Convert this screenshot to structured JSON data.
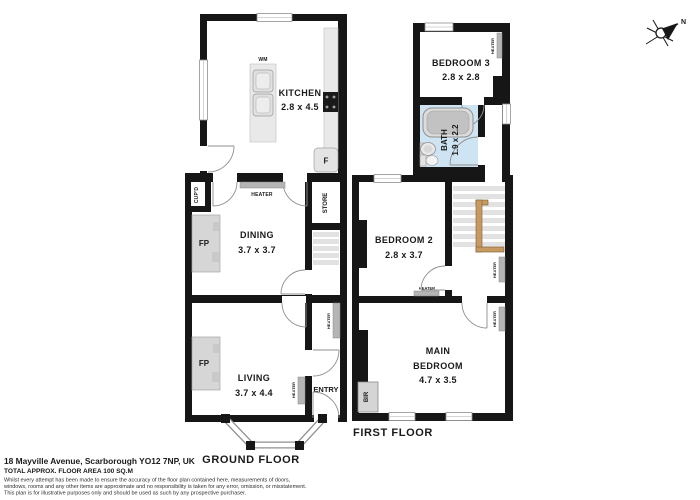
{
  "meta": {
    "address": "18 Mayville Avenue, Scarborough YO12 7NP, UK",
    "area": "TOTAL APPROX. FLOOR AREA 100 SQ.M",
    "disclaimer1": "Whilst every attempt has been made to ensure the accuracy of the floor plan contained here, measurements of doors,",
    "disclaimer2": "windows, rooms and any other items are approximate and no responsibility is taken for any error, omission, or misstatement.",
    "disclaimer3": "This plan is for illustrative purposes only and should be used as such by any prospective purchaser."
  },
  "compass": {
    "north": "N"
  },
  "labels": {
    "heater": "HEATER",
    "fireplace": "FP",
    "washing_machine": "WM",
    "fridge": "F",
    "store": "STORE",
    "cupboard": "CUP'D",
    "entry": "ENTRY",
    "built_in_robe": "BIR"
  },
  "ground_floor": {
    "label": "GROUND FLOOR",
    "kitchen_name": "KITCHEN",
    "kitchen_dims": "2.8 x 4.5",
    "dining_name": "DINING",
    "dining_dims": "3.7 x 3.7",
    "living_name": "LIVING",
    "living_dims": "3.7 x 4.4"
  },
  "first_floor": {
    "label": "FIRST FLOOR",
    "bedroom3_name": "BEDROOM 3",
    "bedroom3_dims": "2.8 x 2.8",
    "bath_name": "BATH",
    "bath_dims": "1.9 x 2.2",
    "bedroom2_name": "BEDROOM 2",
    "bedroom2_dims": "2.8 x 3.7",
    "main_name1": "MAIN",
    "main_name2": "BEDROOM",
    "main_dims": "4.7 x 3.5"
  },
  "colors": {
    "wall": "#161616",
    "bath_floor": "#cfe4f2",
    "banister": "#c79a62",
    "heater": "#b5b5b5"
  }
}
